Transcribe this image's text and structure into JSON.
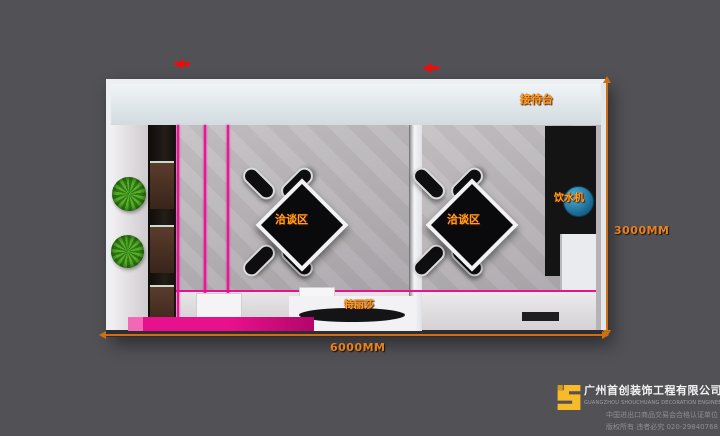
{
  "plan": {
    "reception_label": "接待台",
    "negotiation_left_label": "洽谈区",
    "negotiation_right_label": "洽谈区",
    "water_dispenser_label": "饮水机",
    "brand_board_label": "特丽莎",
    "label_color": "#ffa01e",
    "accent_pink": "#e8138c"
  },
  "dimensions": {
    "width_label": "6000MM",
    "height_label": "3000MM",
    "color": "#e8821e"
  },
  "footer": {
    "company_cn": "广州首创装饰工程有限公司",
    "company_en": "GUANGZHOU SHOUCHUANG DECORATION ENGINEERING CO., LTD.",
    "cert_line": "中国进出口商品交易会合格认证单位",
    "copyright_line": "版权所有 违者必究 020-29840768",
    "logo_color": "#f6ba2a"
  },
  "colors": {
    "background": "#515156",
    "dimension_orange": "#cf6f14",
    "marker_red": "#e41010"
  }
}
